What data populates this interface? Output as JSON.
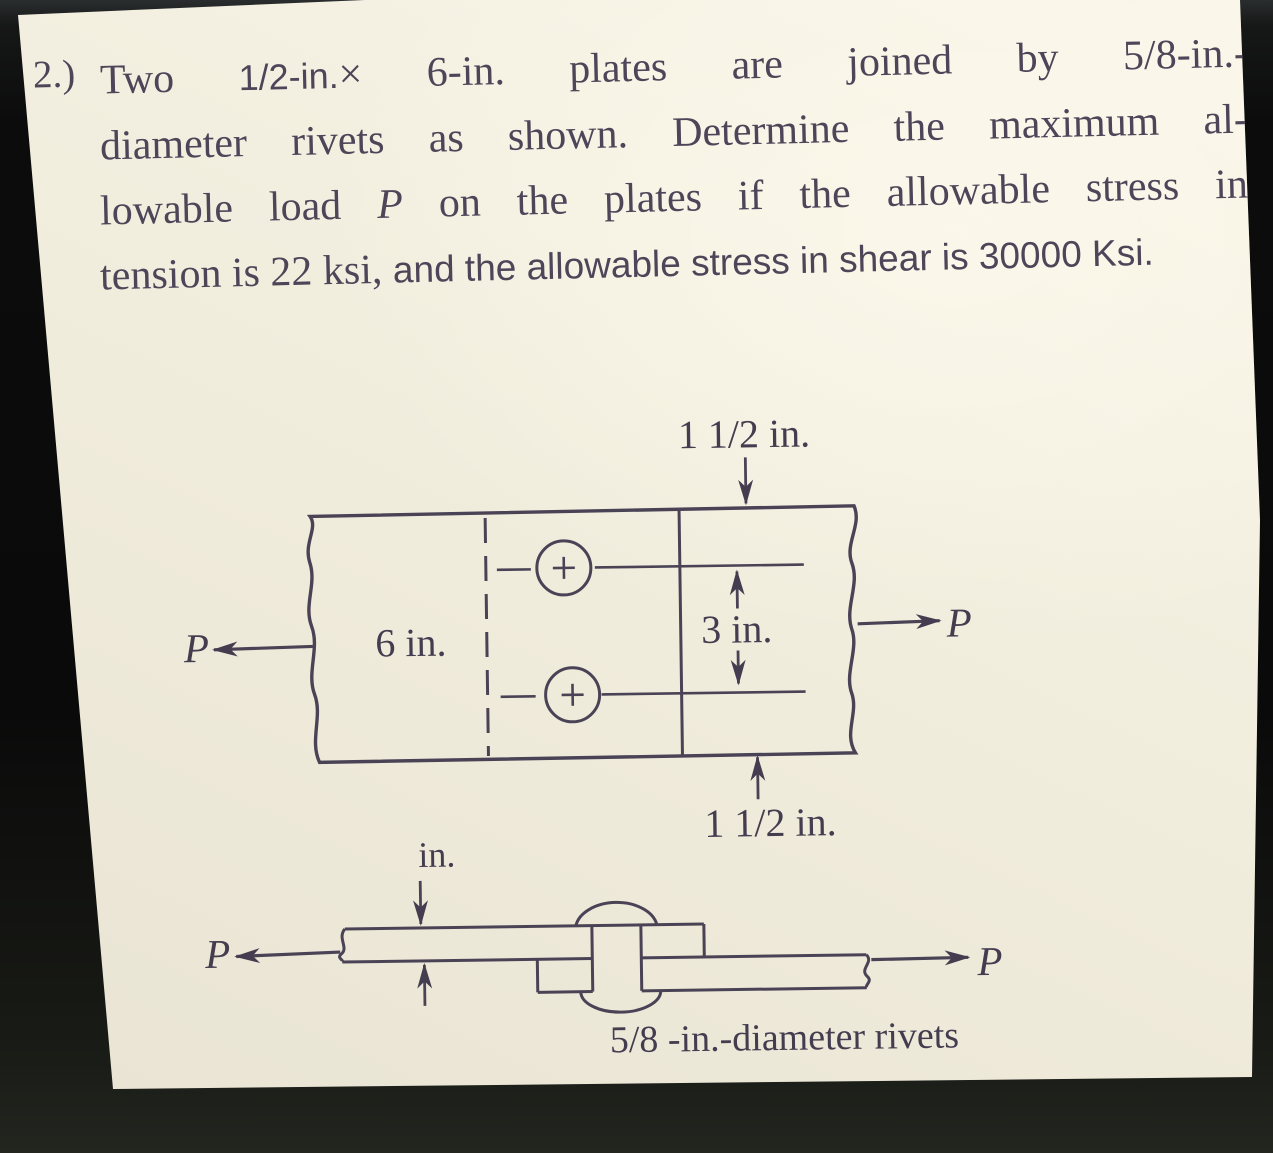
{
  "problem": {
    "number": "2.)",
    "line1_serif_a": "Two ",
    "line1_sans": "1/2-in.",
    "line1_serif_b": "× 6-in. plates are joined by 5/8-in.-",
    "line2": "diameter rivets as shown. Determine the maximum al-",
    "line3_a": "lowable load ",
    "line3_p": "P",
    "line3_b": " on the plates if the allowable stress in",
    "line4_serif": "tension is 22 ksi, ",
    "line4_sans": "and the allowable stress in shear is 30000 Ksi."
  },
  "figure": {
    "top_view": {
      "dim_edge_top": "1 1/2 in.",
      "plate_width": "6 in.",
      "rivet_spacing": "3 in.",
      "dim_edge_bottom": "1 1/2 in.",
      "load_label": "P"
    },
    "side_view": {
      "thickness_unit": "in.",
      "caption": "5/8 -in.-diameter rivets",
      "load_label": "P"
    }
  },
  "style": {
    "paper_color": "#f1eddd",
    "ink_color": "#4d4659",
    "background_color": "#0b0b0b"
  }
}
